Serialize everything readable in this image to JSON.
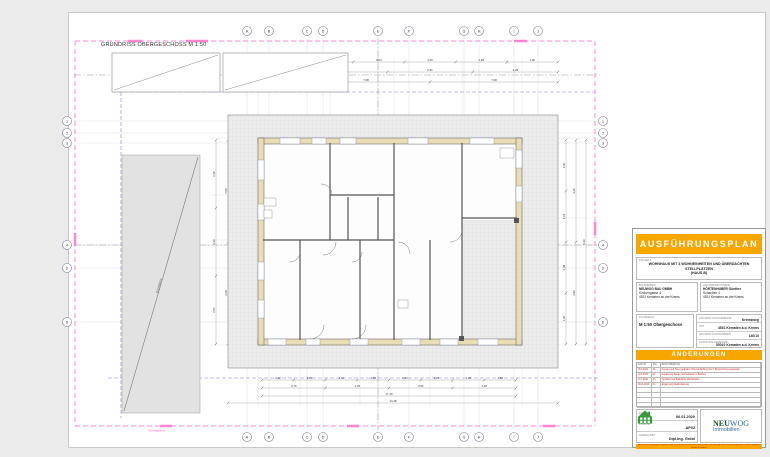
{
  "sheet": {
    "drawing_title": "GRUNDRISS OBERGESCHOSS M 1:50"
  },
  "grid": {
    "letters": [
      "A",
      "B",
      "C",
      "D",
      "E",
      "F",
      "G",
      "H",
      "I",
      "J"
    ],
    "numbers": [
      "1",
      "2",
      "3",
      "4",
      "5",
      "6"
    ]
  },
  "colors": {
    "accent_orange": "#F7A600",
    "boundary_pink": "#EE66CC",
    "highlight_pink": "#FF85D2",
    "furniture_lavender": "#C9C9EF",
    "annotation_red": "#CC3333",
    "axis_blue": "#8080E8",
    "logo_green": "#3A9A3A",
    "logo_blue": "#2E6DA4"
  },
  "plan": {
    "roof_label": "Dachfläche",
    "boundary_label": "Grundgrenze",
    "level_label": "+2,78",
    "room_labels": [
      "Zimmer",
      "Bad",
      "Vorraum",
      "Zimmer",
      "Wohnen / Essen",
      "Terrasse"
    ],
    "dims": {
      "top1": [
        "1,00",
        "3,64",
        "1,26",
        "2,38",
        "1,00"
      ],
      "top2": [
        "4,26",
        "2,51",
        "4,26"
      ],
      "top3": [
        "7,08",
        "7,08"
      ],
      "bottom1": [
        "1,10",
        "1,60",
        "1,10",
        "2,18",
        "1,00",
        "1,87",
        "1,40",
        "1,53"
      ],
      "bottom2": [
        "3,70",
        "4,33",
        "3,54",
        "2,18"
      ],
      "bottom3": [
        "17,10"
      ],
      "bottom4": [
        "14,48"
      ],
      "left1": [
        "2,38",
        "4,26",
        "2,51"
      ],
      "left2": [
        "7,08",
        "2,08"
      ],
      "right1": [
        "1,00",
        "3,64",
        "2,38",
        "1,26"
      ],
      "right2": [
        "4,26",
        "4,90"
      ],
      "right3": [
        "9,16"
      ]
    }
  },
  "titleblock": {
    "header": "AUSFÜHRUNGSPLAN",
    "project_label": "PROJEKT",
    "project_title_line1": "WOHNHAUS MIT 3 WOHNEINHEITEN UND ÜBERDACHTEN STELLPLÄTZEN",
    "project_title_line2": "(HAUS-B)",
    "client_label": "BAUWERBER",
    "client_line1": "NEUWOG BAU GMBH",
    "client_line2": "Kirchengasse 4",
    "client_line3": "4531 Kematen an der Krems",
    "owner_label": "GRUNDEIGENTÜMER",
    "owner_line1": "HÖRTENHUBER Günther",
    "owner_line2": "Schachen 4",
    "owner_line3": "4531 Kematen an der Krems",
    "content_label": "PLANINHALT",
    "content_value": "M 1:50 Obergeschoss",
    "fields": [
      {
        "label": "GRUNDSTÜCKSADRESSE",
        "value": "Kremsweg"
      },
      {
        "label": "ORT",
        "value": "4531 Kematen a.d. Krems"
      },
      {
        "label": "GRUNDSTÜCKSNUMMER",
        "value": "140/10"
      },
      {
        "label": "KATASTRALGEMEINDE",
        "value": "55010 Kematen a.d. Krems"
      }
    ],
    "aenderungen_header": "ÄNDERUNGEN",
    "aenderungen_cols": [
      "DATUM",
      "IND.",
      "BESCHREIBUNG"
    ],
    "aenderungen_rows": [
      {
        "date": "18.3.2020",
        "index": "01",
        "text": "Fenster und Türen geändert, Raumaufteilung OG lt. Besprechung angepasst"
      },
      {
        "date": "14.5.2020",
        "index": "02",
        "text": "Anpassung Stiege und Geländer lt. Bauherr"
      },
      {
        "date": "10.7.2020",
        "index": "03",
        "text": "Terrasse und Stellplätze überarbeitet"
      },
      {
        "date": "19.11.2020",
        "index": "04",
        "text": "Ergänzung Elektroplanung"
      }
    ],
    "date_label": "DATUM",
    "date_value": "06.01.2020",
    "plannr_label": "PLAN NR.",
    "plannr_value": "AP02",
    "drawn_label": "GEZEICHNET",
    "drawn_value": "Dipl.Ing. Gröbl",
    "logo": {
      "brand_bold": "NEU",
      "brand_light": "WOG",
      "subtitle": "Immobilien"
    },
    "footer_note": "Dieser Plan ist geistiges Eigentum des Planverfassers und darf ohne dessen Zustimmung weder vervielfältigt noch Dritten zugänglich gemacht werden!"
  }
}
